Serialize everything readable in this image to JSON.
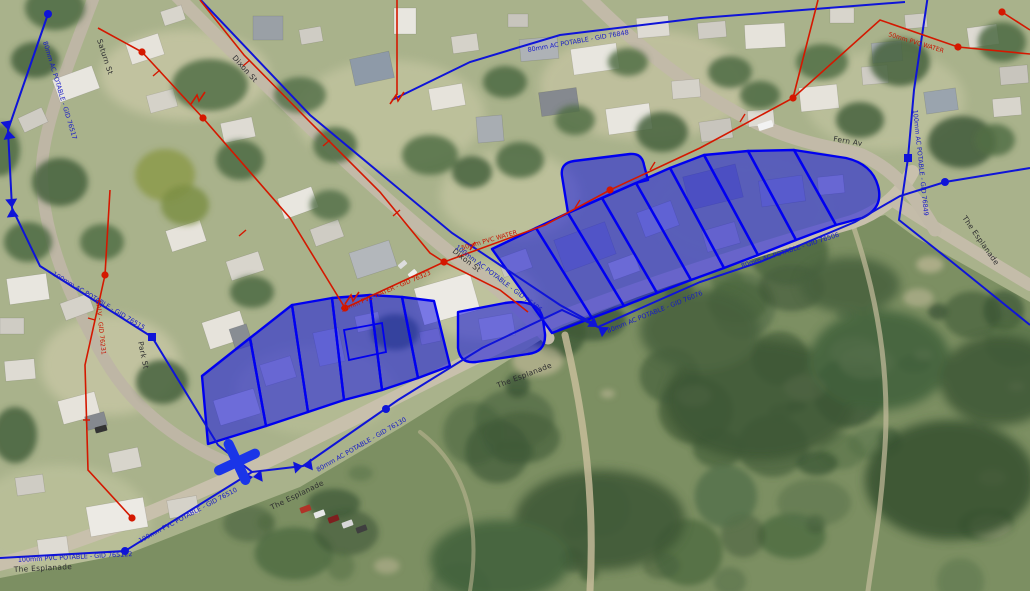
{
  "app": {
    "type": "aerial-gis-map-view",
    "description": "Aerial imagery with selected parcels and water network overlay"
  },
  "colors": {
    "parcel_fill": "#1010e6",
    "parcel_stroke": "#0000f0",
    "potable_main": "#0f14d8",
    "water_service": "#d41800",
    "street_text": "#2e2e30"
  },
  "map_features": {
    "selected_parcels": {
      "count": 17,
      "highlight_color": "#1010e6"
    },
    "marker_types": [
      "valve-bowtie",
      "node-dot",
      "fitting-square",
      "cross-marker",
      "end-cap"
    ]
  },
  "labels": {
    "streets": [
      {
        "text": "Saturn St"
      },
      {
        "text": "Dixon St"
      },
      {
        "text": "Dixon St"
      },
      {
        "text": "Park St"
      },
      {
        "text": "Fern Av"
      },
      {
        "text": "The Esplanade"
      },
      {
        "text": "The Esplanade"
      },
      {
        "text": "The Esplanade"
      },
      {
        "text": "The Esplanade"
      }
    ],
    "pipes": [
      {
        "text": "80mm AC POTABLE - GID 76517",
        "system": "potable"
      },
      {
        "text": "100mm AC POTABLE - GID 76515",
        "system": "potable"
      },
      {
        "text": "100mm AC POTABLE - GID 76406",
        "system": "potable"
      },
      {
        "text": "80mm AC POTABLE - GID 76130",
        "system": "potable"
      },
      {
        "text": "80mm AC POTABLE - GID 76076",
        "system": "potable"
      },
      {
        "text": "80mm AC POTABLE - GID 76506",
        "system": "potable"
      },
      {
        "text": "100mm PVC POTABLE - GID 765122",
        "system": "potable"
      },
      {
        "text": "100mm PVC POTABLE - GID 76510",
        "system": "potable"
      },
      {
        "text": "80mm AC POTABLE - GID 76848",
        "system": "potable"
      },
      {
        "text": "100mm AC POTABLE - GID 76849",
        "system": "potable"
      },
      {
        "text": "50mm PVC WATER - GID 76323",
        "system": "water"
      },
      {
        "text": "50mm PVC WATER",
        "system": "water"
      },
      {
        "text": "GALV - GID 76231",
        "system": "water"
      },
      {
        "text": "50mm PVC WATER",
        "system": "water"
      }
    ]
  }
}
